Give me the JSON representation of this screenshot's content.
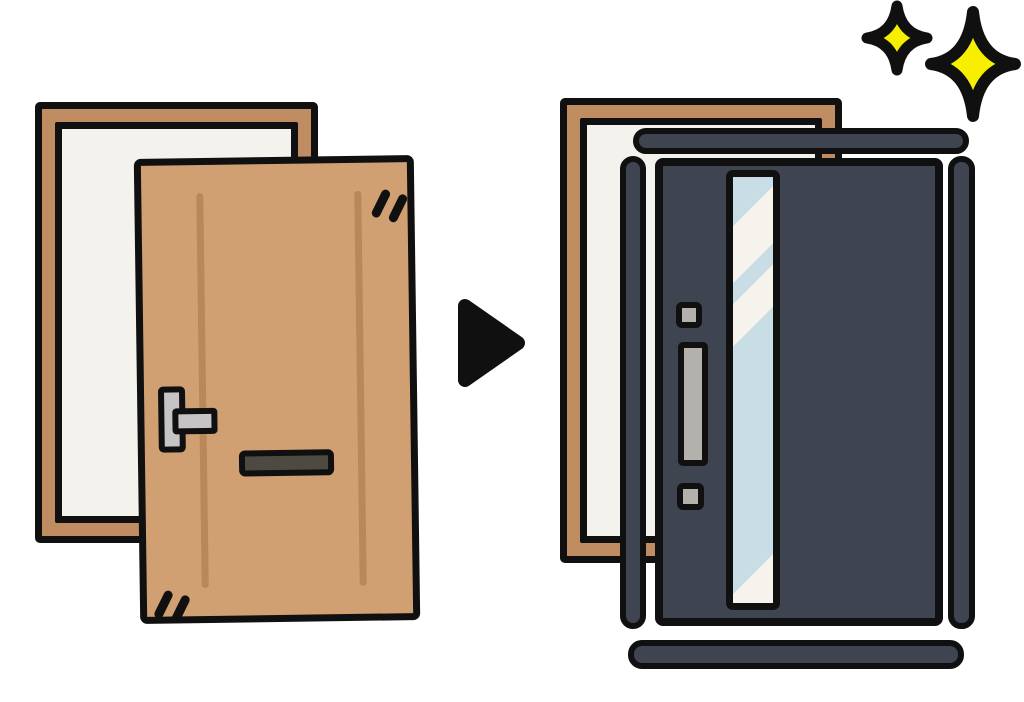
{
  "colors": {
    "background": "#ffffff",
    "outline": "#101010",
    "frame_brown": "#bf8d61",
    "panel_white": "#f4f2ed",
    "door_tan": "#d0a072",
    "grain_brown": "#b8885a",
    "handle_gray": "#c6c4c4",
    "slot_dark": "#4d4a41",
    "new_door_slate": "#3e4450",
    "glass_blue": "#c9dde6",
    "glass_streak": "#f6f3ec",
    "new_handle_gray": "#b4b1ad",
    "sparkle_yellow": "#f7ef00"
  },
  "icons": {
    "arrow": "right-triangle-arrow",
    "sparkles": "four-point-sparkle"
  },
  "scene": {
    "before": {
      "element": "old-wooden-door-with-frame",
      "wood_grain_lines": 2,
      "has_lever_handle": true,
      "has_mail_slot": true,
      "scuff_mark_pairs": 2
    },
    "after": {
      "element": "new-door-with-frame-kit",
      "has_vertical_glass_panel": true,
      "has_handle_bar": true,
      "frame_pieces": 4,
      "sparkle_count": 2
    }
  }
}
